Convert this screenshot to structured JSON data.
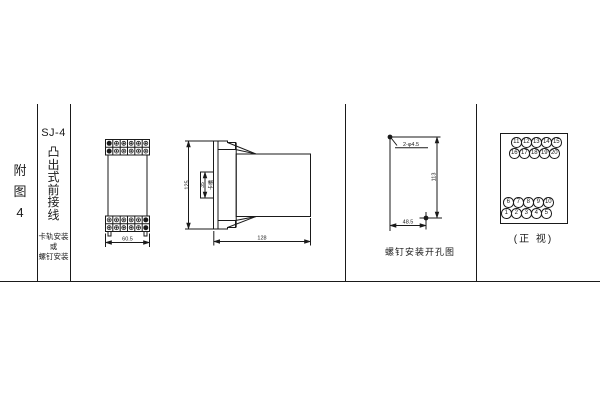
{
  "colors": {
    "ink": "#1a1a1a",
    "paper": "#ffffff"
  },
  "title_block": {
    "figure_label_chars": [
      "附",
      "图",
      "4"
    ],
    "model": "SJ-4",
    "type_chars": [
      "凸",
      "出",
      "式",
      "前",
      "接",
      "线"
    ],
    "mounting_lines": [
      "卡轨安装",
      "或",
      "螺钉安装"
    ]
  },
  "front_view": {
    "width_dim": "60.5"
  },
  "side_view": {
    "height_dim": "125",
    "slot_dim": "35",
    "slot_label": "卡槽",
    "depth_dim": "128"
  },
  "drill_view": {
    "hole_label": "2-φ4.5",
    "height_dim": "113",
    "width_dim": "48.5",
    "caption": "螺钉安装开孔图"
  },
  "terminal_view": {
    "caption": "(正 视)",
    "rows": [
      {
        "numbers": [
          "11",
          "12",
          "13",
          "14",
          "15"
        ]
      },
      {
        "numbers": [
          "16",
          "17",
          "18",
          "19",
          "20"
        ]
      },
      {
        "numbers": [
          "6",
          "7",
          "8",
          "9",
          "10"
        ]
      },
      {
        "numbers": [
          "1",
          "2",
          "3",
          "4",
          "5"
        ]
      }
    ]
  }
}
